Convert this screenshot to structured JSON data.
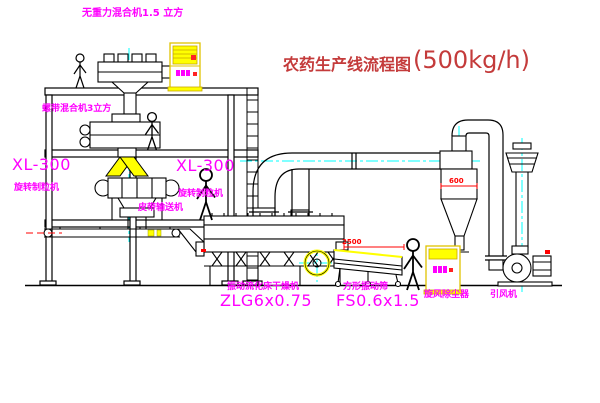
{
  "title": {
    "cn": "农药生产线流程图",
    "capacity": "(500kg/h)"
  },
  "labels": {
    "mixer_top": "无重力混合机1.5 立方",
    "mixer_second": "螺带混合机3立方",
    "granulator_left_model": "XL-300",
    "granulator_left_name": "旋转制粒机",
    "granulator_center_model": "XL-300",
    "granulator_center_name": "旋转制粒机",
    "belt_conveyor": "皮带输送机",
    "dryer_name": "振动流化床干燥机",
    "dryer_model": "ZLG6x0.75",
    "sieve_name": "方形振动筛",
    "sieve_model": "FS0.6x1.5",
    "cyclone": "旋风除尘器",
    "fan": "引风机"
  },
  "dimensions": {
    "cyclone_dia": "600",
    "sieve_length": "2500"
  },
  "colors": {
    "label_magenta": "#ff00ff",
    "title_red": "#c43b3b",
    "dimension_red": "#ff0000",
    "equipment_yellow": "#ffff00",
    "centerline_cyan": "#00ffff",
    "line_black": "#000000"
  }
}
